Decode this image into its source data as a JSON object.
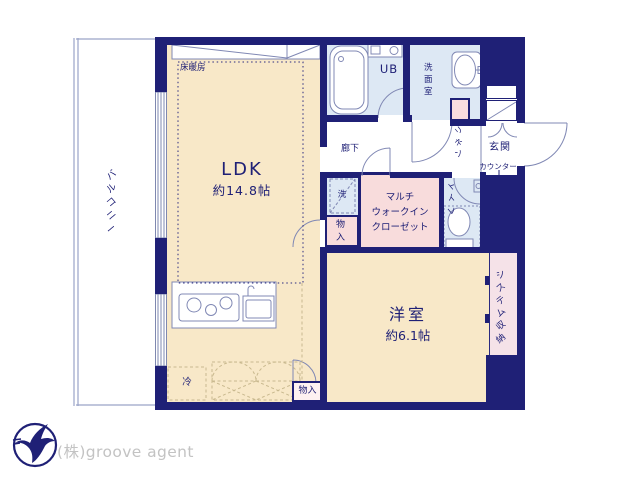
{
  "colors": {
    "wall_navy": "#1f2076",
    "room_cream": "#f8e8c8",
    "wet_area_blue": "#dde8f4",
    "closet_pink": "#f8dcdc",
    "storage_pink": "#f5e2e8",
    "fixture_line": "#8088b4",
    "dash_tan": "#c9b98f",
    "logo_text_gray": "#c3c3c3"
  },
  "plan": {
    "balcony": {
      "label": "バルコニー"
    },
    "ldk": {
      "label": "LDK",
      "size": "約14.8帖",
      "floor_heating_label": "床暖房",
      "fridge_label": "冷"
    },
    "storage_bottom": {
      "label": "物入"
    },
    "storage_mid": {
      "label": "物入"
    },
    "laundry": {
      "label": "洗"
    },
    "walk_in_closet": {
      "line1": "マルチ",
      "line2": "ウォークイン",
      "line3": "クローゼット"
    },
    "western_room": {
      "label": "洋室",
      "size": "約6.1帖"
    },
    "system_storage": {
      "label": "システム収納"
    },
    "toilet": {
      "label": "トイレ"
    },
    "corridor": {
      "label": "廊下"
    },
    "unit_bath": {
      "label": "UB"
    },
    "washroom": {
      "label": "洗面室"
    },
    "linen": {
      "label": "リネン"
    },
    "entrance": {
      "label": "玄関",
      "counter_label": "カウンター"
    }
  },
  "footer": {
    "company": "(株)groove agent"
  }
}
